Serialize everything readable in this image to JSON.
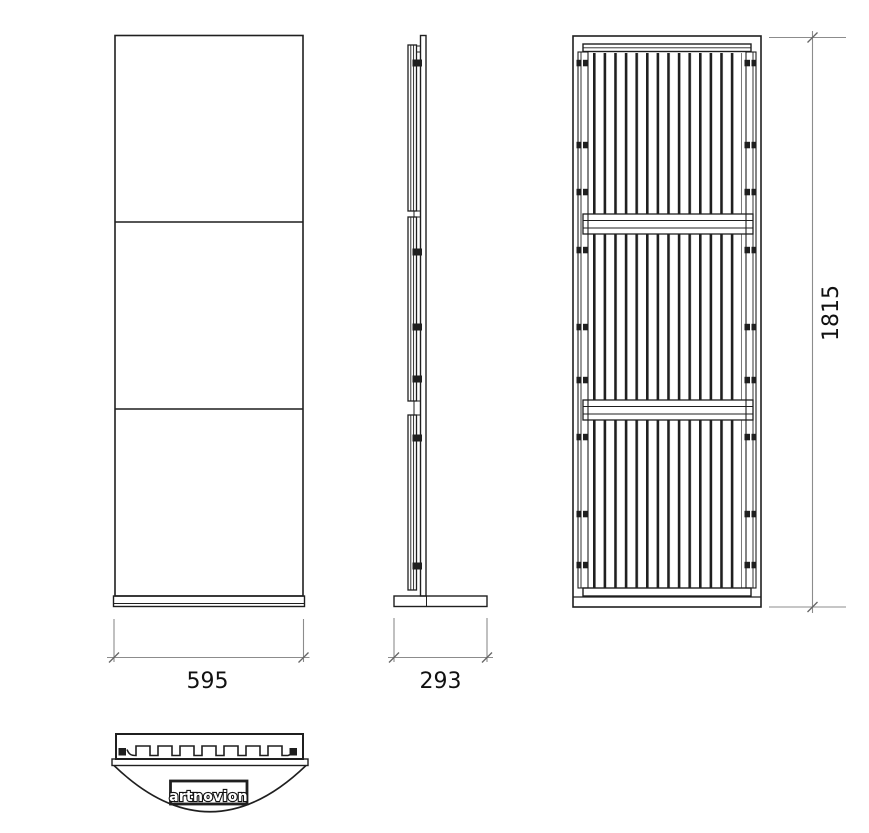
{
  "colors": {
    "background": "#ffffff",
    "line": "#1f1f1f",
    "dimension_line": "#8c8c8c",
    "text": "#111111"
  },
  "dimensions": {
    "front_width": "595",
    "side_depth": "293",
    "overall_height": "1815"
  },
  "logo": {
    "text": "artnovion"
  }
}
